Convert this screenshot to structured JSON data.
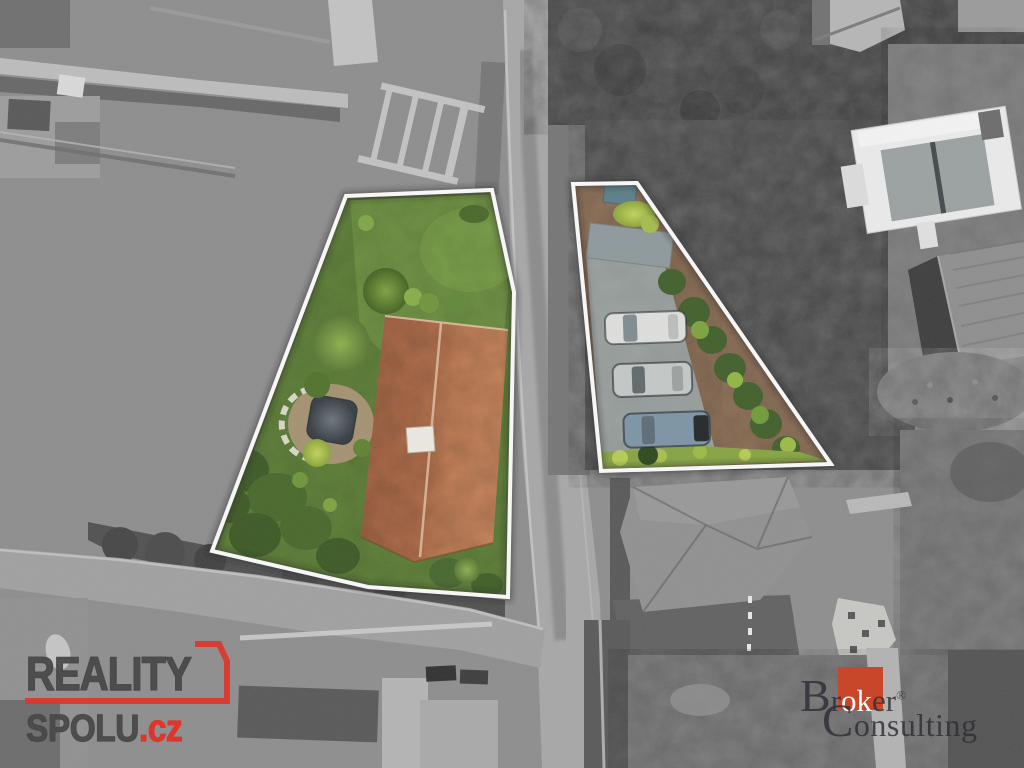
{
  "watermarks": {
    "reality_spolu": {
      "line1": "REALITY",
      "line2": "SPOLU",
      "tld": ".cz",
      "text_color": "#4a4a4a",
      "accent_color": "#dd362b"
    },
    "broker_consulting": {
      "initial1": "B",
      "seg1": "r",
      "highlight": "ok",
      "seg2": "er",
      "registered": "®",
      "initial2": "C",
      "seg3": "onsulting",
      "text_color": "#2f3038",
      "square_color": "#c84629"
    }
  },
  "scene": {
    "kind": "aerial-drone-photo-real-estate",
    "highlighted_plots": 2,
    "visible_parked_cars": 3,
    "palette": {
      "monochrome_base": "#8c8c8c",
      "lawn_green": "#5b7d33",
      "roof_terracotta": "#b5704a",
      "plot_boundary_white": "#fafafa",
      "hedge_dark_green": "#3e5d28",
      "parking_concrete": "#9aa19f"
    }
  }
}
